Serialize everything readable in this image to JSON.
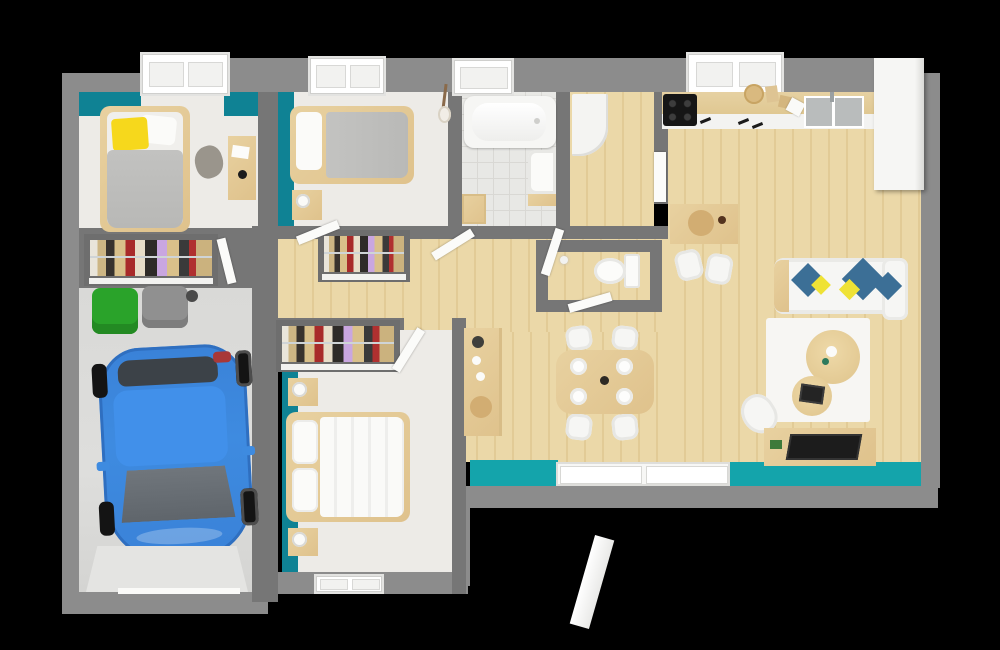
{
  "meta": {
    "title": "3D floor plan render",
    "view": "top-down dollhouse render",
    "has_text": false
  },
  "colors": {
    "background": "#000000",
    "outer_wall": "#8c8c8c",
    "inner_wall": "#767676",
    "teal_accent": "#0f8294",
    "terrace_teal": "#14a4ab",
    "wood_floor": "#ebd8a8",
    "wood_line": "#e2cb96",
    "room_floor": "#edebe7",
    "tile_floor": "#e8e8e5",
    "tile_line": "#d9d8d4",
    "furn_wood": "#e8d1a0",
    "bed_gray": "#bcbcbc",
    "bedding_white": "#f7f7f5",
    "pillow_yellow": "#f6d81c",
    "pillow_blue": "#3c6f96",
    "pillow_yellow2": "#efe235",
    "car_blue": "#3e8be0",
    "car_glass": "#676d73",
    "bin_green": "#2aa32a",
    "bin_gray": "#909090",
    "appliance_black": "#161616",
    "sink_gray": "#b9bcbc"
  },
  "rooms": [
    {
      "name": "bedroom-1",
      "furniture": [
        "single-bed",
        "yellow-pillow",
        "desk",
        "desk-chair",
        "wardrobe-with-clothes"
      ]
    },
    {
      "name": "bedroom-2",
      "furniture": [
        "single-bed",
        "nightstand",
        "lamp",
        "guitar"
      ]
    },
    {
      "name": "bathroom",
      "furniture": [
        "bathtub",
        "washbasin",
        "wooden-stool"
      ]
    },
    {
      "name": "entry-hall",
      "furniture": [
        "white-wardrobe"
      ]
    },
    {
      "name": "wc",
      "furniture": [
        "toilet"
      ]
    },
    {
      "name": "kitchen",
      "furniture": [
        "cooktop",
        "counter",
        "double-sink",
        "tall-white-cabinet",
        "breakfast-table",
        "two-chairs",
        "cutting-board"
      ]
    },
    {
      "name": "dining-area",
      "furniture": [
        "wooden-table",
        "four-chairs",
        "four-plates"
      ]
    },
    {
      "name": "living-room",
      "furniture": [
        "corner-sofa",
        "blue-yellow-cushions",
        "white-rug",
        "round-coffee-table-large",
        "round-coffee-table-small",
        "desk",
        "laptop",
        "office-chair",
        "sideboard"
      ]
    },
    {
      "name": "master-bedroom",
      "furniture": [
        "double-bed",
        "two-nightstands",
        "lamps",
        "wardrobe-with-clothes"
      ]
    },
    {
      "name": "garage",
      "furniture": [
        "blue-car",
        "green-bin",
        "gray-bin"
      ]
    },
    {
      "name": "terrace",
      "furniture": [
        "sliding-glass-door"
      ]
    },
    {
      "name": "hallway",
      "furniture": [
        "two-wardrobes-with-clothes"
      ]
    }
  ]
}
